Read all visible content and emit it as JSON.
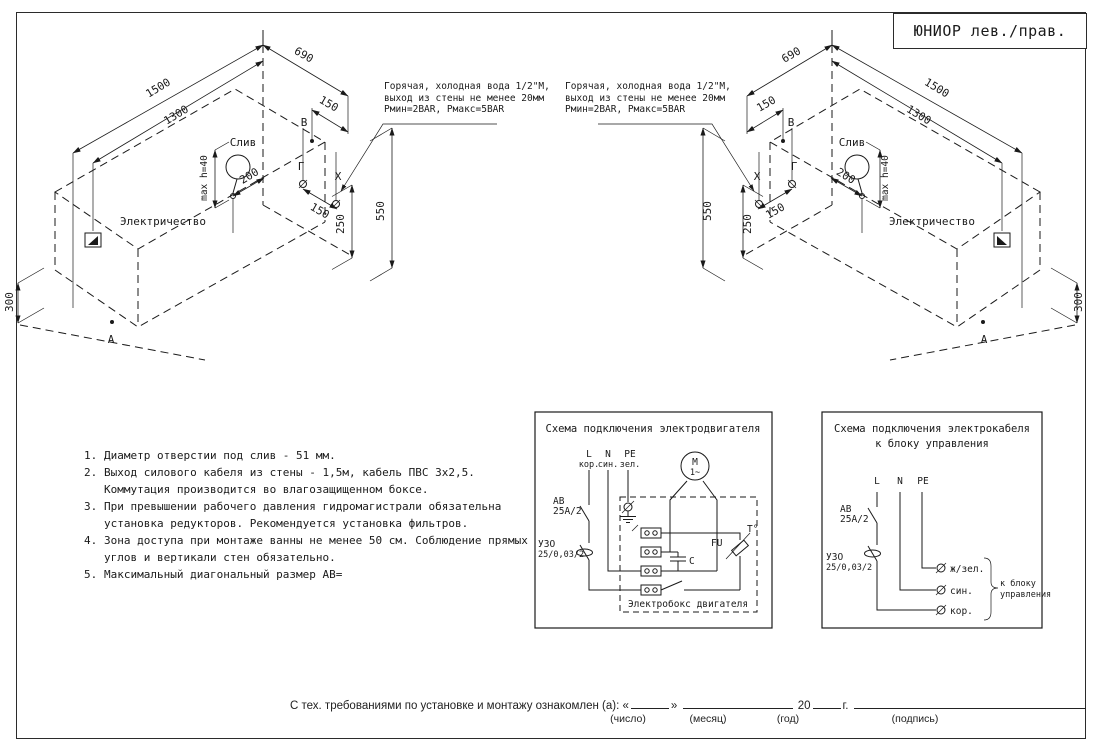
{
  "frame": {
    "title_block": "ЮНИОР лев./прав."
  },
  "iso": {
    "dims": {
      "width": "1500",
      "inner_width": "1300",
      "depth": "690",
      "offset_top": "150",
      "offset_bottom": "150",
      "h250": "250",
      "h550": "550",
      "h300": "300",
      "drain_offset": "200",
      "max_height": "max h=40"
    },
    "labels": {
      "drain": "Слив",
      "electricity": "Электричество",
      "point_a": "А",
      "point_b": "В",
      "point_g": "Г",
      "point_x": "X"
    },
    "water_note": {
      "line1": "Горячая, холодная вода 1/2\"М,",
      "line2": "выход из стены не менее 20мм",
      "line3": "Рмин=2BAR, Рмакс=5BAR"
    }
  },
  "notes": {
    "n1": "1.",
    "t1": "Диаметр отверстии под слив - 51 мм.",
    "n2": "2.",
    "t2a": "Выход силового кабеля из стены - 1,5м, кабель ПВС 3х2,5.",
    "t2b": "Коммутация производится во влагозащищенном боксе.",
    "n3": "3.",
    "t3a": "При превышении рабочего давления гидромагистрали обязательна",
    "t3b": "установка редукторов. Рекомендуется установка фильтров.",
    "n4": "4.",
    "t4a": "Зона доступа при монтаже ванны не менее 50 см. Соблюдение прямых",
    "t4b": "углов и вертикали стен обязательно.",
    "n5": "5.",
    "t5": "Максимальный диагональный размер АВ="
  },
  "scheme_motor": {
    "title": "Схема подключения электродвигателя",
    "phase_l": "L",
    "phase_l_color": "кор.",
    "phase_n": "N",
    "phase_n_color": "син.",
    "phase_pe": "PE",
    "phase_pe_color": "зел.",
    "breaker": "АВ",
    "breaker_rating": "25А/2",
    "rcd": "УЗО",
    "rcd_rating": "25/0,03/2",
    "motor": "М",
    "motor_phase": "1~",
    "capacitor": "C",
    "fuse": "FU",
    "thermal": "Т°",
    "box_label": "Электробокс двигателя"
  },
  "scheme_cable": {
    "title_line1": "Схема подключения электрокабеля",
    "title_line2": "к блоку управления",
    "phase_l": "L",
    "phase_n": "N",
    "phase_pe": "PE",
    "breaker": "АВ",
    "breaker_rating": "25А/2",
    "rcd": "УЗО",
    "rcd_rating": "25/0,03/2",
    "wire_pe": "ж/зел.",
    "wire_n": "син.",
    "wire_l": "кор.",
    "bracket_line1": "к блоку",
    "bracket_line2": "управления"
  },
  "signature": {
    "text": "С тех. требованиями по установке и монтажу ознакомлен (а):",
    "quote_open": "«",
    "quote_close": "»",
    "year_prefix": "20",
    "year_suffix": "г.",
    "label_day": "(число)",
    "label_month": "(месяц)",
    "label_year": "(год)",
    "label_sign": "(подпись)"
  }
}
